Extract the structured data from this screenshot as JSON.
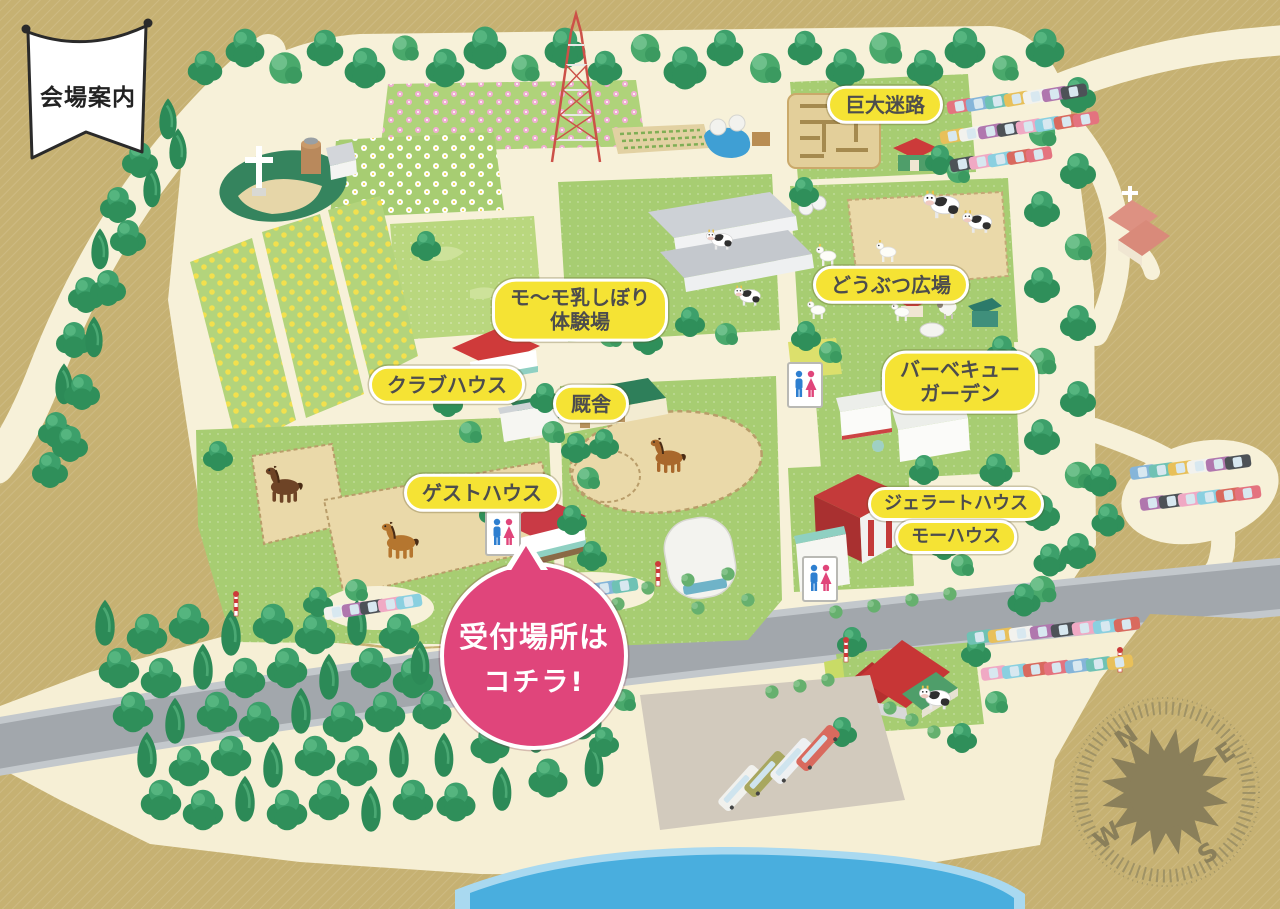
{
  "banner": {
    "text": "会場案内"
  },
  "labels": {
    "giant_maze": "巨大迷路",
    "milking_line1": "モ〜モ乳しぼり",
    "milking_line2": "体験場",
    "animal_plaza": "どうぶつ広場",
    "clubhouse": "クラブハウス",
    "stable": "厩舎",
    "bbq_line1": "バーベキュー",
    "bbq_line2": "ガーデン",
    "guest_house": "ゲストハウス",
    "gelato_house": "ジェラートハウス",
    "moo_house": "モーハウス"
  },
  "callout": {
    "line1": "受付場所は",
    "line2": "コチラ!"
  },
  "compass": {
    "north": "N",
    "east": "E",
    "south": "S",
    "west": "W"
  },
  "icons": {
    "restroom": "restroom-men-women-icon",
    "compass": "compass-rose-icon",
    "banner": "flag-banner-icon"
  },
  "colors": {
    "label_bg": "#F5E334",
    "label_text": "#4D4D4D",
    "callout_bg": "#E0457B",
    "callout_text": "#FFFFFF",
    "banner_bg": "#FFFFFF",
    "banner_border": "#2A2A2A",
    "map_base": "#C6B172",
    "grass_green": "#A7CD72",
    "path_cream": "#F7F1D9",
    "forest_green": "#2F8F5A",
    "highway_gray": "#A2A7AC",
    "water_blue": "#49AEDE",
    "compass_olive": "#8A7F5A"
  }
}
